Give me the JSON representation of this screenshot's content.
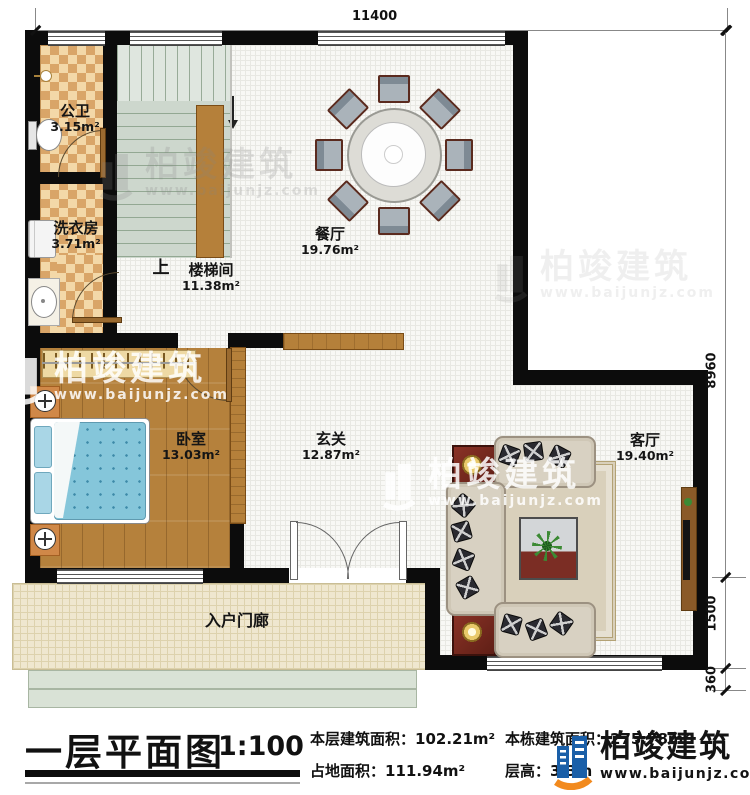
{
  "watermark": {
    "brand": "柏竣建筑",
    "url": "www.baijunjz.com"
  },
  "dimensions": {
    "top_width": "11400",
    "right_main": "8960",
    "right_porch": "1500",
    "right_steps": "360"
  },
  "rooms": {
    "bathroom": {
      "name": "公卫",
      "area": "3.15m²"
    },
    "laundry": {
      "name": "洗衣房",
      "area": "3.71m²"
    },
    "stair": {
      "name": "楼梯间",
      "area": "11.38m²",
      "up": "上"
    },
    "dining": {
      "name": "餐厅",
      "area": "19.76m²"
    },
    "bedroom": {
      "name": "卧室",
      "area": "13.03m²"
    },
    "foyer": {
      "name": "玄关",
      "area": "12.87m²"
    },
    "living": {
      "name": "客厅",
      "area": "19.40m²"
    },
    "porch": {
      "name": "入户门廊"
    }
  },
  "title_block": {
    "title": "一层平面图",
    "scale": "1:100",
    "floor_area_label": "本层建筑面积：",
    "floor_area_value": "102.21m²",
    "land_area_label": "占地面积：",
    "land_area_value": "111.94m²",
    "total_area_label": "本栋建筑面积：",
    "total_area_value": "275.78m²",
    "height_label": "层高：",
    "height_value": "3.3m"
  }
}
